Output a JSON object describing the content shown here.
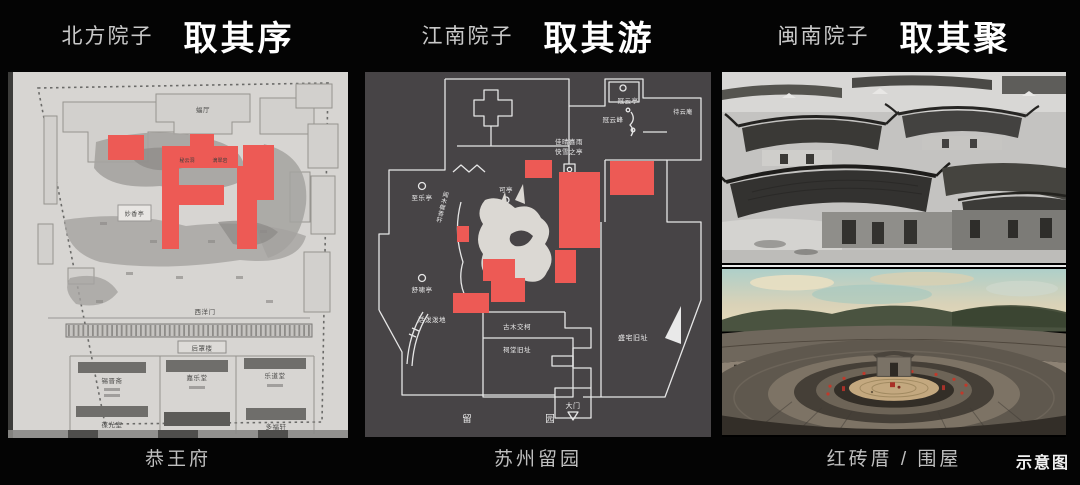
{
  "panels": [
    {
      "subtitle": "北方院子",
      "title": "取其序",
      "caption": "恭王府"
    },
    {
      "subtitle": "江南院子",
      "title": "取其游",
      "caption": "苏州留园"
    },
    {
      "subtitle": "闽南院子",
      "title": "取其聚",
      "caption": "红砖厝 / 围屋"
    }
  ],
  "corner_note": "示意图",
  "map_gongwangfu": {
    "labels": {
      "futing": "蝠厅",
      "miyundong": "秘云洞",
      "dicuiyan": "滴翠岩",
      "miaoxiangting": "妙香亭",
      "xiyangmen": "西洋门",
      "houzhaolou": "后罩楼",
      "xijinzhai": "锡晋斋",
      "jialetang": "嘉乐堂",
      "ledaotang": "乐道堂",
      "baoguangshi": "葆光室",
      "duofuxuan": "多福轩"
    }
  },
  "map_liuyuan": {
    "labels": {
      "guanyunting": "冠云亭",
      "guanyunfeng": "冠云峰",
      "daiyunan": "待云庵",
      "jiaqing": "佳晴喜雨",
      "kuaixue": "快雪之亭",
      "keting": "可亭",
      "zhileting": "至乐亭",
      "wenmuxi": "闻木樨香轩",
      "shuxiaoting": "舒啸亭",
      "huopopodi": "活泼泼地",
      "gumujiaoke": "古木交柯",
      "citang": "祠堂旧址",
      "shengzhai": "盛宅旧址",
      "damen": "大门",
      "liu": "留",
      "yuan": "园"
    }
  },
  "colors": {
    "background": "#040404",
    "highlight_red": "#ed5a55",
    "map1_paper": "#d7d5d2",
    "map2_background": "#474446",
    "map2_line": "#e6e6e6",
    "caption_gray": "#bfbfbf"
  }
}
